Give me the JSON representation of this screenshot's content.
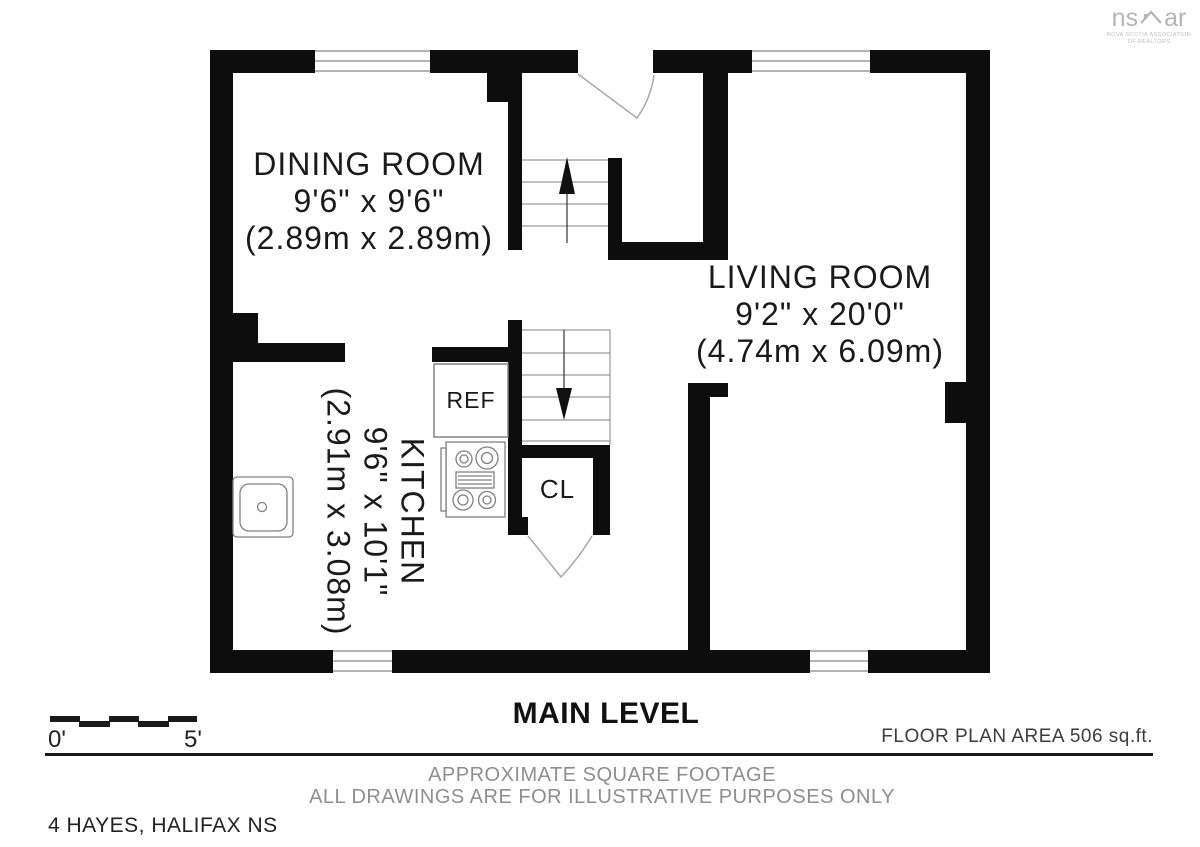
{
  "logo": {
    "text_left": "ns",
    "text_right": "ar",
    "caption_line1": "NOVA SCOTIA ASSOCIATION",
    "caption_line2": "OF REALTORS"
  },
  "rooms": {
    "dining": {
      "name": "DINING ROOM",
      "dims_imperial": "9'6\" x 9'6\"",
      "dims_metric": "(2.89m x 2.89m)"
    },
    "living": {
      "name": "LIVING ROOM",
      "dims_imperial": "9'2\" x 20'0\"",
      "dims_metric": "(4.74m x 6.09m)"
    },
    "kitchen": {
      "name": "KITCHEN",
      "dims_imperial": "9'6\" x 10'1\"",
      "dims_metric": "(2.91m x 3.08m)"
    }
  },
  "fixtures": {
    "refrigerator_label": "REF",
    "closet_label": "CL"
  },
  "title": "MAIN LEVEL",
  "scale_bar": {
    "start_label": "0'",
    "end_label": "5'"
  },
  "area_note": "FLOOR PLAN AREA 506 sq.ft.",
  "disclaimer_line1": "APPROXIMATE SQUARE FOOTAGE",
  "disclaimer_line2": "ALL DRAWINGS ARE FOR ILLUSTRATIVE PURPOSES ONLY",
  "address": "4 HAYES, HALIFAX NS",
  "colors": {
    "wall": "#0d0d0d",
    "thin_line": "#9a9a9a",
    "fixture_stroke": "#808080",
    "disclaimer_gray": "#8e8e8e",
    "logo_gray": "#b5b5b5"
  }
}
